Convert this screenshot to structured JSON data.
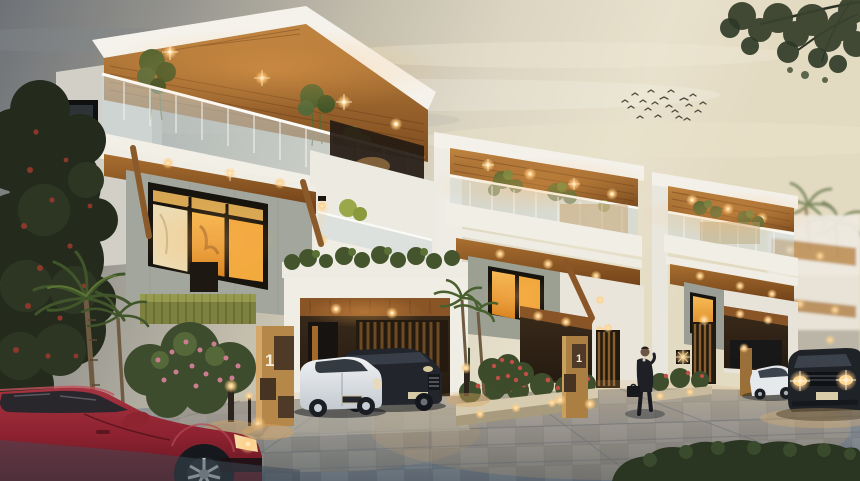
{
  "meta": {
    "description": "Twilight 3D architectural rendering of a row of modern two-storey luxury villas with wooden soffits, glass balconies, warm accent lighting, landscaped paver driveway, parked cars, a businessman walking, and a flock of birds in a cream dusk sky.",
    "time_of_day": "dusk"
  },
  "signs": {
    "villa1_plot_number": "1",
    "villa2_plot_number": "1"
  },
  "scene": {
    "villa_count": 4,
    "vehicles": [
      "dark red coupe (foreground)",
      "white hatchback in carport",
      "dark SUV in carport",
      "white sedan at right",
      "black SUV with headlights on (right edge)"
    ],
    "person": "man in dark suit carrying a briefcase",
    "wildlife": "flock of birds",
    "vegetation": [
      "flowering tree (left)",
      "palm trees",
      "frangipani shrubs with pink flowers",
      "hedge (bottom right)",
      "overhanging tree branch (top right)"
    ]
  },
  "palette": {
    "sky_gray": "#6e7277",
    "sky_cream": "#e8e1cc",
    "wood_soffit": "#9a5c26",
    "wall_white": "#f3f0e9",
    "concrete": "#a2a69c",
    "warm_light": "#ffc878",
    "pavement_dark": "#5f6a74",
    "car_red": "#8e2230",
    "foliage_dark": "#2b3423",
    "flower_pink": "#cd7d92"
  }
}
